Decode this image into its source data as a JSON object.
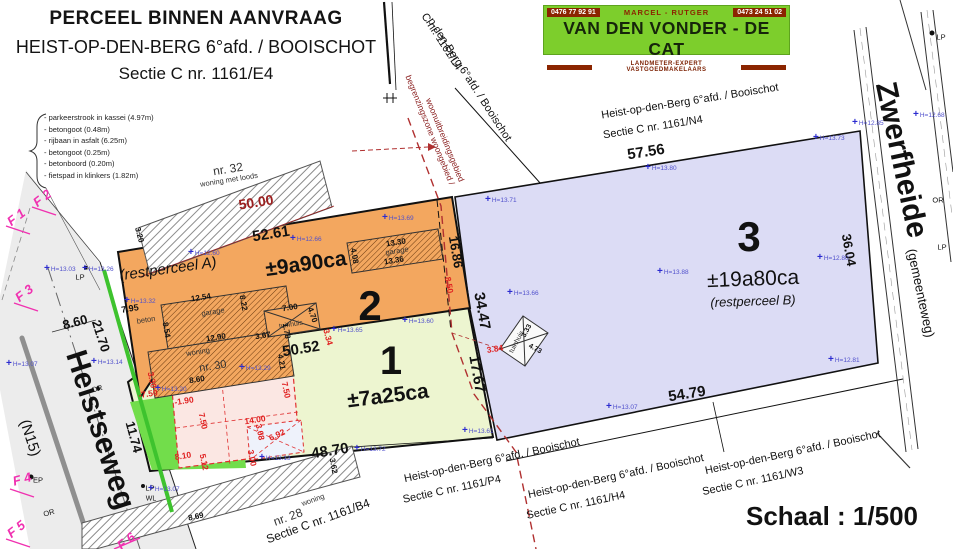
{
  "title_block": {
    "line1": "PERCEEL BINNEN AANVRAAG",
    "line2": "HEIST-OP-DEN-BERG 6°afd. / BOOISCHOT",
    "line3": "Sectie C nr. 1161/E4"
  },
  "banner": {
    "phone_left": "0476 77 92 91",
    "names": "MARCEL - RUTGER",
    "phone_right": "0473 24 51 02",
    "company": "VAN DEN VONDER - DE CAT",
    "tagline": "LANDMETER-EXPERT VASTGOEDMAKELAARS"
  },
  "legend": {
    "items": [
      "- parkeerstrook in kassei (4.97m)",
      "- betongoot (0.48m)",
      "- rijbaan in asfalt (6.25m)",
      "- betongoot (0.25m)",
      "- betonboord (0.20m)",
      "- fietspad in klinkers (1.82m)"
    ]
  },
  "scale": {
    "label": "Schaal : 1/500"
  },
  "colors": {
    "parcel_2": "#f3a75f",
    "parcel_1": "#edf5d0",
    "parcel_3": "#dcdcf5",
    "green_zone": "#72dd4b",
    "proposed_building": "#fbe7e3",
    "proposed_garage": "#eef2fb",
    "road": "#ececec",
    "zone_boundary_red": "#b03030",
    "measure_red": "#e02020",
    "elevation_blue": "#5050cc",
    "photo_magenta": "#f030b0",
    "banner_green": "#7dce2c",
    "banner_dark_red": "#8b2500"
  },
  "plan": {
    "symbols": {
      "elevation_plus": "+"
    },
    "parcels_summary": [
      {
        "number": "2",
        "area": "±9a90ca",
        "note": "(restperceel A)"
      },
      {
        "number": "1",
        "area": "±7a25ca",
        "note": ""
      },
      {
        "number": "3",
        "area": "±19a80ca",
        "note": "(restperceel B)"
      }
    ],
    "labels": [
      {
        "n": "restperceel-a-label",
        "t": "(restperceel A)",
        "x": 168,
        "y": 269,
        "r": -8,
        "s": 15,
        "i": true
      },
      {
        "n": "parcel-2-area",
        "t": "±9a90ca",
        "x": 306,
        "y": 264,
        "r": -8,
        "s": 21,
        "w": 700
      },
      {
        "n": "parcel-2-number",
        "t": "2",
        "x": 370,
        "y": 306,
        "r": 0,
        "s": 42,
        "w": 700
      },
      {
        "n": "parcel-1-number",
        "t": "1",
        "x": 391,
        "y": 361,
        "r": 0,
        "s": 40,
        "w": 700
      },
      {
        "n": "parcel-1-area",
        "t": "±7a25ca",
        "x": 388,
        "y": 396,
        "r": -7,
        "s": 21,
        "w": 700
      },
      {
        "n": "parcel-3-number",
        "t": "3",
        "x": 749,
        "y": 237,
        "r": 0,
        "s": 42,
        "w": 700
      },
      {
        "n": "parcel-3-area",
        "t": "±19a80ca",
        "x": 753,
        "y": 279,
        "r": -2,
        "s": 21
      },
      {
        "n": "restperceel-b-label",
        "t": "(restperceel B)",
        "x": 753,
        "y": 301,
        "r": -2,
        "s": 13,
        "i": true
      },
      {
        "n": "road-name-heistseweg",
        "t": "Heistseweg",
        "x": 100,
        "y": 430,
        "r": 72,
        "s": 30,
        "w": 700
      },
      {
        "n": "road-ref-n15",
        "t": "(N15)",
        "x": 30,
        "y": 438,
        "r": 72,
        "s": 15
      },
      {
        "n": "road-name-zwerfheide",
        "t": "Zwerfheide",
        "x": 901,
        "y": 160,
        "r": 78,
        "s": 30,
        "w": 700
      },
      {
        "n": "road-note-gemeenteweg",
        "t": "(gemeenteweg)",
        "x": 921,
        "y": 293,
        "r": 78,
        "s": 13
      },
      {
        "n": "section-l4-line1",
        "t": "p-den-Berg 6°afd. / Booischot",
        "x": 469,
        "y": 80,
        "r": 57,
        "s": 11
      },
      {
        "n": "section-l4-line2",
        "t": "C nr. 1161/L4",
        "x": 441,
        "y": 42,
        "r": 57,
        "s": 11
      },
      {
        "n": "section-n4-line1",
        "t": "Heist-op-den-Berg 6°afd. / Booischot",
        "x": 690,
        "y": 102,
        "r": -9,
        "s": 11
      },
      {
        "n": "section-n4-line2",
        "t": "Sectie C nr. 1161/N4",
        "x": 653,
        "y": 128,
        "r": -9,
        "s": 11
      },
      {
        "n": "section-p4-line1",
        "t": "Heist-op-den-Berg 6°afd. / Booischot",
        "x": 492,
        "y": 461,
        "r": -12,
        "s": 11
      },
      {
        "n": "section-p4-line2",
        "t": "Sectie C nr. 1161/P4",
        "x": 452,
        "y": 490,
        "r": -12,
        "s": 11
      },
      {
        "n": "section-h4-line1",
        "t": "Heist-op-den-Berg 6°afd. / Booischot",
        "x": 616,
        "y": 477,
        "r": -12,
        "s": 11
      },
      {
        "n": "section-h4-line2",
        "t": "Sectie C nr. 1161/H4",
        "x": 576,
        "y": 506,
        "r": -12,
        "s": 11
      },
      {
        "n": "section-w3-line1",
        "t": "Heist-op-den-Berg 6°afd. / Booischot",
        "x": 793,
        "y": 453,
        "r": -12,
        "s": 11
      },
      {
        "n": "section-w3-line2",
        "t": "Sectie C nr. 1161/W3",
        "x": 753,
        "y": 482,
        "r": -12,
        "s": 11
      },
      {
        "n": "section-b4-line",
        "t": "Sectie C nr. 1161/B4",
        "x": 318,
        "y": 521,
        "r": -20,
        "s": 12
      },
      {
        "n": "zone-boundary-text-1",
        "t": "begrenzingszone woongebied /",
        "x": 430,
        "y": 130,
        "r": 68,
        "s": 8.5,
        "c": "#8b2020"
      },
      {
        "n": "zone-boundary-text-2",
        "t": "woonuitbreidingsgebied",
        "x": 445,
        "y": 140,
        "r": 68,
        "s": 8.5,
        "c": "#8b2020"
      },
      {
        "n": "building-nr32-number",
        "t": "nr. 32",
        "x": 228,
        "y": 169,
        "r": -9,
        "s": 12,
        "c": "#333"
      },
      {
        "n": "building-nr32-type",
        "t": "woning met loods",
        "x": 229,
        "y": 180,
        "r": -9,
        "s": 7.5,
        "c": "#333"
      },
      {
        "n": "building-garage2-label",
        "t": "garage",
        "x": 397,
        "y": 251,
        "r": -9,
        "s": 7.5,
        "c": "#333"
      },
      {
        "n": "building-garage-label",
        "t": "garage",
        "x": 213,
        "y": 312,
        "r": -9,
        "s": 7.5,
        "c": "#333"
      },
      {
        "n": "building-woning-label",
        "t": "woning",
        "x": 198,
        "y": 352,
        "r": -9,
        "s": 7.5,
        "c": "#333"
      },
      {
        "n": "building-nr30-number",
        "t": "nr. 30",
        "x": 213,
        "y": 367,
        "r": -9,
        "s": 11,
        "c": "#333"
      },
      {
        "n": "building-tuinhuis2-label",
        "t": "tuinhuis",
        "x": 291,
        "y": 325,
        "r": -9,
        "s": 7,
        "c": "#333"
      },
      {
        "n": "building-tuinhuis3-label",
        "t": "tuinhuis",
        "x": 517,
        "y": 342,
        "r": -62,
        "s": 7,
        "c": "#333"
      },
      {
        "n": "building-nr28-type",
        "t": "woning",
        "x": 313,
        "y": 500,
        "r": -20,
        "s": 7.5,
        "c": "#333"
      },
      {
        "n": "building-nr28-number",
        "t": "nr. 28",
        "x": 288,
        "y": 517,
        "r": -20,
        "s": 12,
        "c": "#333"
      },
      {
        "n": "surface-beton-label",
        "t": "beton",
        "x": 146,
        "y": 320,
        "r": -9,
        "s": 7.5,
        "c": "#333"
      },
      {
        "n": "dim-57-56",
        "t": "57.56",
        "x": 646,
        "y": 152,
        "r": -9,
        "s": 15,
        "w": 700
      },
      {
        "n": "dim-52-61",
        "t": "52.61",
        "x": 271,
        "y": 234,
        "r": -9,
        "s": 15,
        "w": 700
      },
      {
        "n": "dim-50-00",
        "t": "50.00",
        "x": 256,
        "y": 202,
        "r": -9,
        "s": 14,
        "w": 700,
        "c": "#9b2020"
      },
      {
        "n": "dim-50-52",
        "t": "50.52",
        "x": 301,
        "y": 349,
        "r": -9,
        "s": 15,
        "w": 700
      },
      {
        "n": "dim-48-70",
        "t": "48.70",
        "x": 330,
        "y": 451,
        "r": -9,
        "s": 15,
        "w": 700
      },
      {
        "n": "dim-54-79",
        "t": "54.79",
        "x": 687,
        "y": 394,
        "r": -9,
        "s": 15,
        "w": 700
      },
      {
        "n": "dim-34-47",
        "t": "34.47",
        "x": 482,
        "y": 311,
        "r": 80,
        "s": 15,
        "w": 700
      },
      {
        "n": "dim-17-67",
        "t": "17.67",
        "x": 477,
        "y": 374,
        "r": 80,
        "s": 15,
        "w": 700
      },
      {
        "n": "dim-16-86",
        "t": "16.86",
        "x": 456,
        "y": 252,
        "r": 80,
        "s": 13,
        "w": 700
      },
      {
        "n": "dim-36-04",
        "t": "36.04",
        "x": 849,
        "y": 250,
        "r": 80,
        "s": 13,
        "w": 700
      },
      {
        "n": "dim-21-70",
        "t": "21.70",
        "x": 101,
        "y": 336,
        "r": 72,
        "s": 13,
        "w": 700
      },
      {
        "n": "dim-8-60",
        "t": "8.60",
        "x": 75,
        "y": 322,
        "r": -15,
        "s": 13,
        "w": 700
      },
      {
        "n": "dim-11-74",
        "t": "11.74",
        "x": 134,
        "y": 437,
        "r": 75,
        "s": 13,
        "w": 700
      },
      {
        "n": "dim-7-95",
        "t": "7.95",
        "x": 130,
        "y": 309,
        "r": -9,
        "s": 9,
        "w": 700
      },
      {
        "n": "dim-13-30",
        "t": "13.30",
        "x": 396,
        "y": 243,
        "r": -9,
        "s": 8,
        "w": 700
      },
      {
        "n": "dim-13-36",
        "t": "13.36",
        "x": 394,
        "y": 261,
        "r": -9,
        "s": 8,
        "w": 700
      },
      {
        "n": "dim-4-08",
        "t": "4.08",
        "x": 354,
        "y": 256,
        "r": 80,
        "s": 8,
        "w": 700
      },
      {
        "n": "dim-12-54",
        "t": "12.54",
        "x": 201,
        "y": 298,
        "r": -9,
        "s": 8,
        "w": 700
      },
      {
        "n": "dim-8-54",
        "t": "8.54",
        "x": 166,
        "y": 330,
        "r": 80,
        "s": 8,
        "w": 700
      },
      {
        "n": "dim-8-22",
        "t": "8.22",
        "x": 243,
        "y": 303,
        "r": 80,
        "s": 8,
        "w": 700
      },
      {
        "n": "dim-12-90",
        "t": "12.90",
        "x": 216,
        "y": 338,
        "r": -9,
        "s": 8,
        "w": 700
      },
      {
        "n": "dim-3-67",
        "t": "3.67",
        "x": 263,
        "y": 336,
        "r": -9,
        "s": 8,
        "w": 700
      },
      {
        "n": "dim-1-78",
        "t": "1.78",
        "x": 286,
        "y": 331,
        "r": 80,
        "s": 8,
        "w": 700
      },
      {
        "n": "dim-8-60b",
        "t": "8.60",
        "x": 197,
        "y": 380,
        "r": -9,
        "s": 8,
        "w": 700
      },
      {
        "n": "dim-4-21",
        "t": "4.21",
        "x": 281,
        "y": 362,
        "r": 80,
        "s": 8,
        "w": 700
      },
      {
        "n": "dim-7-00",
        "t": "7.00",
        "x": 290,
        "y": 308,
        "r": -9,
        "s": 8,
        "w": 700
      },
      {
        "n": "dim-4-70",
        "t": "4.70",
        "x": 312,
        "y": 315,
        "r": 70,
        "s": 8,
        "w": 700
      },
      {
        "n": "dim-3-62",
        "t": "3.62",
        "x": 333,
        "y": 466,
        "r": 80,
        "s": 8,
        "w": 700
      },
      {
        "n": "dim-3-20",
        "t": "3.20",
        "x": 139,
        "y": 235,
        "r": 75,
        "s": 8,
        "w": 700
      },
      {
        "n": "dim-8-69",
        "t": "8.69",
        "x": 196,
        "y": 517,
        "r": -12,
        "s": 8,
        "w": 700
      },
      {
        "n": "dim-3-33",
        "t": "3.33",
        "x": 527,
        "y": 331,
        "r": -62,
        "s": 7,
        "w": 700
      },
      {
        "n": "dim-4-73",
        "t": "4.73",
        "x": 535,
        "y": 349,
        "r": 28,
        "s": 7,
        "w": 700
      },
      {
        "n": "red-dim-m7-50",
        "t": "-7.50",
        "x": 148,
        "y": 394,
        "r": -9,
        "s": 8.5,
        "w": 700,
        "c": "#e02020"
      },
      {
        "n": "red-dim-m1-90",
        "t": "-1.90",
        "x": 184,
        "y": 401,
        "r": -9,
        "s": 8.5,
        "w": 700,
        "c": "#e02020"
      },
      {
        "n": "red-dim-7-50a",
        "t": "7.50",
        "x": 203,
        "y": 421,
        "r": 78,
        "s": 8.5,
        "w": 700,
        "c": "#e02020"
      },
      {
        "n": "red-dim-7-50b",
        "t": "7.50",
        "x": 286,
        "y": 390,
        "r": 78,
        "s": 8.5,
        "w": 700,
        "c": "#e02020"
      },
      {
        "n": "red-dim-14-00",
        "t": "14.00",
        "x": 255,
        "y": 420,
        "r": -9,
        "s": 8.5,
        "w": 700,
        "c": "#e02020"
      },
      {
        "n": "red-dim-8-10",
        "t": "8.10",
        "x": 183,
        "y": 456,
        "r": -9,
        "s": 8.5,
        "w": 700,
        "c": "#e02020"
      },
      {
        "n": "red-dim-5-12",
        "t": "5.12",
        "x": 204,
        "y": 462,
        "r": 78,
        "s": 8.5,
        "w": 700,
        "c": "#e02020"
      },
      {
        "n": "red-dim-3-00",
        "t": "3.00",
        "x": 252,
        "y": 458,
        "r": 78,
        "s": 8.5,
        "w": 700,
        "c": "#e02020"
      },
      {
        "n": "red-dim-3-08",
        "t": "3.08",
        "x": 260,
        "y": 432,
        "r": 78,
        "s": 8.5,
        "w": 700,
        "c": "#e02020"
      },
      {
        "n": "red-dim-6-92",
        "t": "6.92",
        "x": 277,
        "y": 435,
        "r": -25,
        "s": 8.5,
        "w": 700,
        "c": "#e02020"
      },
      {
        "n": "red-dim-8-50",
        "t": "8.50",
        "x": 449,
        "y": 285,
        "r": 80,
        "s": 8.5,
        "w": 700,
        "c": "#e02020"
      },
      {
        "n": "red-dim-3-34",
        "t": "3.34",
        "x": 328,
        "y": 337,
        "r": 75,
        "s": 8.5,
        "w": 700,
        "c": "#e02020"
      },
      {
        "n": "red-dim-3-84",
        "t": "3.84",
        "x": 495,
        "y": 349,
        "r": -9,
        "s": 8.5,
        "w": 700,
        "c": "#e02020"
      },
      {
        "n": "red-dim-3-30",
        "t": "3.30",
        "x": 152,
        "y": 380,
        "r": 78,
        "s": 8.5,
        "w": 700,
        "c": "#e02020"
      },
      {
        "n": "photo-point-f1",
        "t": "F 1",
        "x": 16,
        "y": 217,
        "r": -38,
        "s": 13,
        "w": 700,
        "i": true,
        "c": "#f030b0"
      },
      {
        "n": "photo-point-f2",
        "t": "F 2",
        "x": 42,
        "y": 198,
        "r": -38,
        "s": 13,
        "w": 700,
        "i": true,
        "c": "#f030b0"
      },
      {
        "n": "photo-point-f3",
        "t": "F 3",
        "x": 24,
        "y": 293,
        "r": -38,
        "s": 13,
        "w": 700,
        "i": true,
        "c": "#f030b0"
      },
      {
        "n": "photo-point-f4",
        "t": "F 4",
        "x": 22,
        "y": 479,
        "r": -15,
        "s": 13,
        "w": 700,
        "i": true,
        "c": "#f030b0"
      },
      {
        "n": "photo-point-f5",
        "t": "F 5",
        "x": 16,
        "y": 529,
        "r": -38,
        "s": 13,
        "w": 700,
        "i": true,
        "c": "#f030b0"
      },
      {
        "n": "photo-point-f6",
        "t": "F 6",
        "x": 126,
        "y": 541,
        "r": -38,
        "s": 13,
        "w": 700,
        "i": true,
        "c": "#f030b0"
      },
      {
        "n": "mark-lp-1",
        "t": "LP",
        "x": 80,
        "y": 277,
        "r": 0,
        "s": 7.5
      },
      {
        "n": "mark-lp-2",
        "t": "LP",
        "x": 150,
        "y": 488,
        "r": 0,
        "s": 7.5
      },
      {
        "n": "mark-lp-3",
        "t": "LP",
        "x": 941,
        "y": 37,
        "r": 0,
        "s": 7.5
      },
      {
        "n": "mark-lp-4",
        "t": "LP",
        "x": 942,
        "y": 247,
        "r": 0,
        "s": 7.5
      },
      {
        "n": "mark-or-1",
        "t": "OR",
        "x": 97,
        "y": 389,
        "r": -15,
        "s": 7.5
      },
      {
        "n": "mark-or-2",
        "t": "OR",
        "x": 49,
        "y": 513,
        "r": -15,
        "s": 7.5
      },
      {
        "n": "mark-or-3",
        "t": "OR",
        "x": 938,
        "y": 200,
        "r": 0,
        "s": 7.5
      },
      {
        "n": "mark-ep",
        "t": "EP",
        "x": 38,
        "y": 480,
        "r": 0,
        "s": 7.5
      },
      {
        "n": "mark-wl",
        "t": "WL",
        "x": 151,
        "y": 499,
        "r": 0,
        "s": 7
      }
    ],
    "elevation_markers": [
      {
        "x": 190,
        "y": 247,
        "t": "H=12.60"
      },
      {
        "x": 292,
        "y": 233,
        "t": "H=12.66"
      },
      {
        "x": 384,
        "y": 212,
        "t": "H=13.69"
      },
      {
        "x": 487,
        "y": 194,
        "t": "H=13.71"
      },
      {
        "x": 647,
        "y": 162,
        "t": "H=13.80"
      },
      {
        "x": 815,
        "y": 132,
        "t": "H=13.73"
      },
      {
        "x": 854,
        "y": 117,
        "t": "H=12.85"
      },
      {
        "x": 915,
        "y": 109,
        "t": "H=12.68"
      },
      {
        "x": 126,
        "y": 295,
        "t": "H=13.32"
      },
      {
        "x": 659,
        "y": 266,
        "t": "H=13.88"
      },
      {
        "x": 819,
        "y": 252,
        "t": "H=12.80"
      },
      {
        "x": 509,
        "y": 287,
        "t": "H=13.66"
      },
      {
        "x": 333,
        "y": 324,
        "t": "H=13.65"
      },
      {
        "x": 404,
        "y": 315,
        "t": "H=13.60"
      },
      {
        "x": 241,
        "y": 362,
        "t": "H=13.29"
      },
      {
        "x": 157,
        "y": 383,
        "t": "H=13.20"
      },
      {
        "x": 261,
        "y": 452,
        "t": "H=13.13"
      },
      {
        "x": 356,
        "y": 443,
        "t": "H=13.72"
      },
      {
        "x": 464,
        "y": 425,
        "t": "H=13.61"
      },
      {
        "x": 608,
        "y": 401,
        "t": "H=13.07"
      },
      {
        "x": 150,
        "y": 483,
        "t": "H=13.07"
      },
      {
        "x": 8,
        "y": 358,
        "t": "H=13.07"
      },
      {
        "x": 93,
        "y": 356,
        "t": "H=13.14"
      },
      {
        "x": 46,
        "y": 263,
        "t": "H=13.03"
      },
      {
        "x": 84,
        "y": 263,
        "t": "H=13.26"
      },
      {
        "x": 830,
        "y": 354,
        "t": "H=12.81"
      }
    ]
  }
}
